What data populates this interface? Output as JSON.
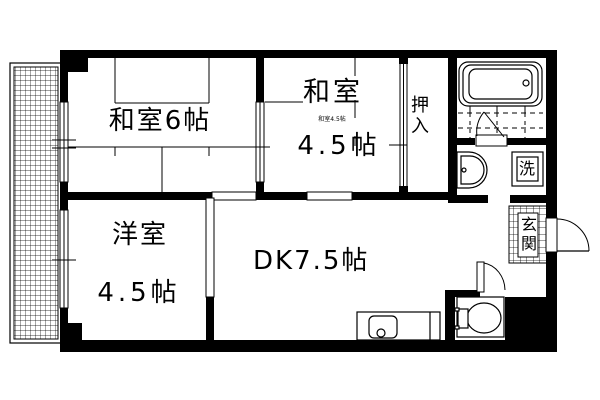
{
  "floorplan": {
    "type": "japanese-apartment-floor-plan",
    "colors": {
      "line": "#000000",
      "background": "#ffffff"
    },
    "rooms": {
      "japanese6": {
        "label": "和室6帖"
      },
      "japanese45": {
        "name_line": "和室",
        "size_line": "4.5帖",
        "small_note": "和室4.5帖"
      },
      "western45": {
        "name_line": "洋室",
        "size_line": "4.5帖"
      },
      "dining_kitchen": {
        "label": "DK7.5帖"
      },
      "closet": {
        "label": "押入"
      },
      "entrance": {
        "label": "玄関"
      },
      "laundry": {
        "label": "洗"
      }
    },
    "fixtures": [
      "bathtub",
      "bath-tile-floor",
      "washbasin",
      "washing-machine-space",
      "toilet",
      "kitchen-sink",
      "entrance-tile",
      "balcony"
    ]
  }
}
